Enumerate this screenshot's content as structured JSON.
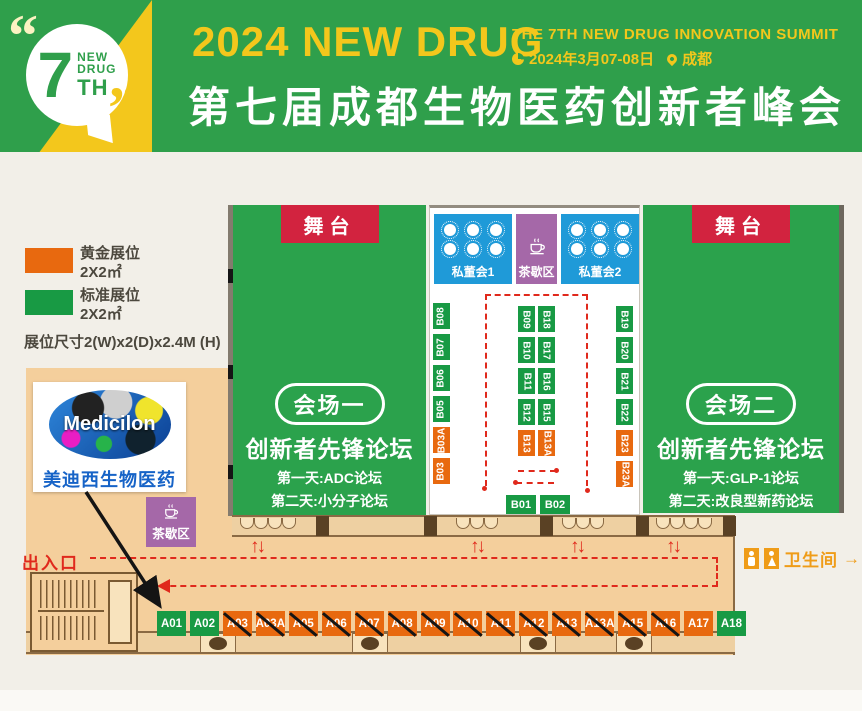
{
  "header": {
    "badge": {
      "quote_open": "“",
      "number": "7",
      "word1": "NEW",
      "word2": "DRUG",
      "word3": "TH",
      "quote_close": "”"
    },
    "title_en": "2024 NEW DRUG",
    "subtitle_en": "THE 7TH NEW DRUG INNOVATION SUMMIT",
    "event_date": "2024年3月07-08日",
    "event_city": "成都",
    "title_cn": "第七届成都生物医药创新者峰会"
  },
  "legend": {
    "gold_label": "黄金展位",
    "gold_size": "2X2㎡",
    "standard_label": "标准展位",
    "standard_size": "2X2㎡",
    "dimension_note": "展位尺寸2(W)x2(D)x2.4M (H)",
    "colors": {
      "gold": "#e8690f",
      "standard": "#189a44"
    }
  },
  "sponsor": {
    "logo_text": "Medicilon",
    "name_cn": "美迪西生物医药"
  },
  "hall1": {
    "stage": "舞台",
    "name": "会场一",
    "forum": "创新者先锋论坛",
    "day1": "第一天:ADC论坛",
    "day2": "第二天:小分子论坛"
  },
  "hall2": {
    "stage": "舞台",
    "name": "会场二",
    "forum": "创新者先锋论坛",
    "day1": "第一天:GLP-1论坛",
    "day2": "第二天:改良型新药论坛"
  },
  "center_area": {
    "private_board1": "私董会1",
    "tea_break_top": "茶歇区",
    "private_board2": "私董会2",
    "tea_break_side": "茶歇区"
  },
  "signs": {
    "entrance": "出入口",
    "restroom": "卫生间",
    "restroom_arrow": "→",
    "updown": "↑↓"
  },
  "booths": {
    "b_left": [
      {
        "id": "B08",
        "type": "standard"
      },
      {
        "id": "B07",
        "type": "standard"
      },
      {
        "id": "B06",
        "type": "standard"
      },
      {
        "id": "B05",
        "type": "standard"
      },
      {
        "id": "B03A",
        "type": "gold"
      },
      {
        "id": "B03",
        "type": "gold"
      }
    ],
    "b_island_left": [
      {
        "id": "B09",
        "type": "standard"
      },
      {
        "id": "B10",
        "type": "standard"
      },
      {
        "id": "B11",
        "type": "standard"
      },
      {
        "id": "B12",
        "type": "standard"
      },
      {
        "id": "B13",
        "type": "gold"
      }
    ],
    "b_island_right": [
      {
        "id": "B18",
        "type": "standard"
      },
      {
        "id": "B17",
        "type": "standard"
      },
      {
        "id": "B16",
        "type": "standard"
      },
      {
        "id": "B15",
        "type": "standard"
      },
      {
        "id": "B13A",
        "type": "gold"
      }
    ],
    "b_right": [
      {
        "id": "B19",
        "type": "standard"
      },
      {
        "id": "B20",
        "type": "standard"
      },
      {
        "id": "B21",
        "type": "standard"
      },
      {
        "id": "B22",
        "type": "standard"
      },
      {
        "id": "B23",
        "type": "gold"
      },
      {
        "id": "B23A",
        "type": "gold"
      }
    ],
    "b_front": [
      {
        "id": "B01",
        "type": "standard"
      },
      {
        "id": "B02",
        "type": "standard"
      }
    ],
    "a_row": [
      {
        "id": "A01",
        "type": "standard",
        "sold": false
      },
      {
        "id": "A02",
        "type": "standard",
        "sold": false
      },
      {
        "id": "A03",
        "type": "gold",
        "sold": true
      },
      {
        "id": "A03A",
        "type": "gold",
        "sold": true
      },
      {
        "id": "A05",
        "type": "gold",
        "sold": true
      },
      {
        "id": "A06",
        "type": "gold",
        "sold": true
      },
      {
        "id": "A07",
        "type": "gold",
        "sold": true
      },
      {
        "id": "A08",
        "type": "gold",
        "sold": true
      },
      {
        "id": "A09",
        "type": "gold",
        "sold": true
      },
      {
        "id": "A10",
        "type": "gold",
        "sold": true
      },
      {
        "id": "A11",
        "type": "gold",
        "sold": true
      },
      {
        "id": "A12",
        "type": "gold",
        "sold": true
      },
      {
        "id": "A13",
        "type": "gold",
        "sold": true
      },
      {
        "id": "A13A",
        "type": "gold",
        "sold": true
      },
      {
        "id": "A15",
        "type": "gold",
        "sold": true
      },
      {
        "id": "A16",
        "type": "gold",
        "sold": true
      },
      {
        "id": "A17",
        "type": "gold",
        "sold": false
      },
      {
        "id": "A18",
        "type": "standard",
        "sold": false
      }
    ]
  }
}
